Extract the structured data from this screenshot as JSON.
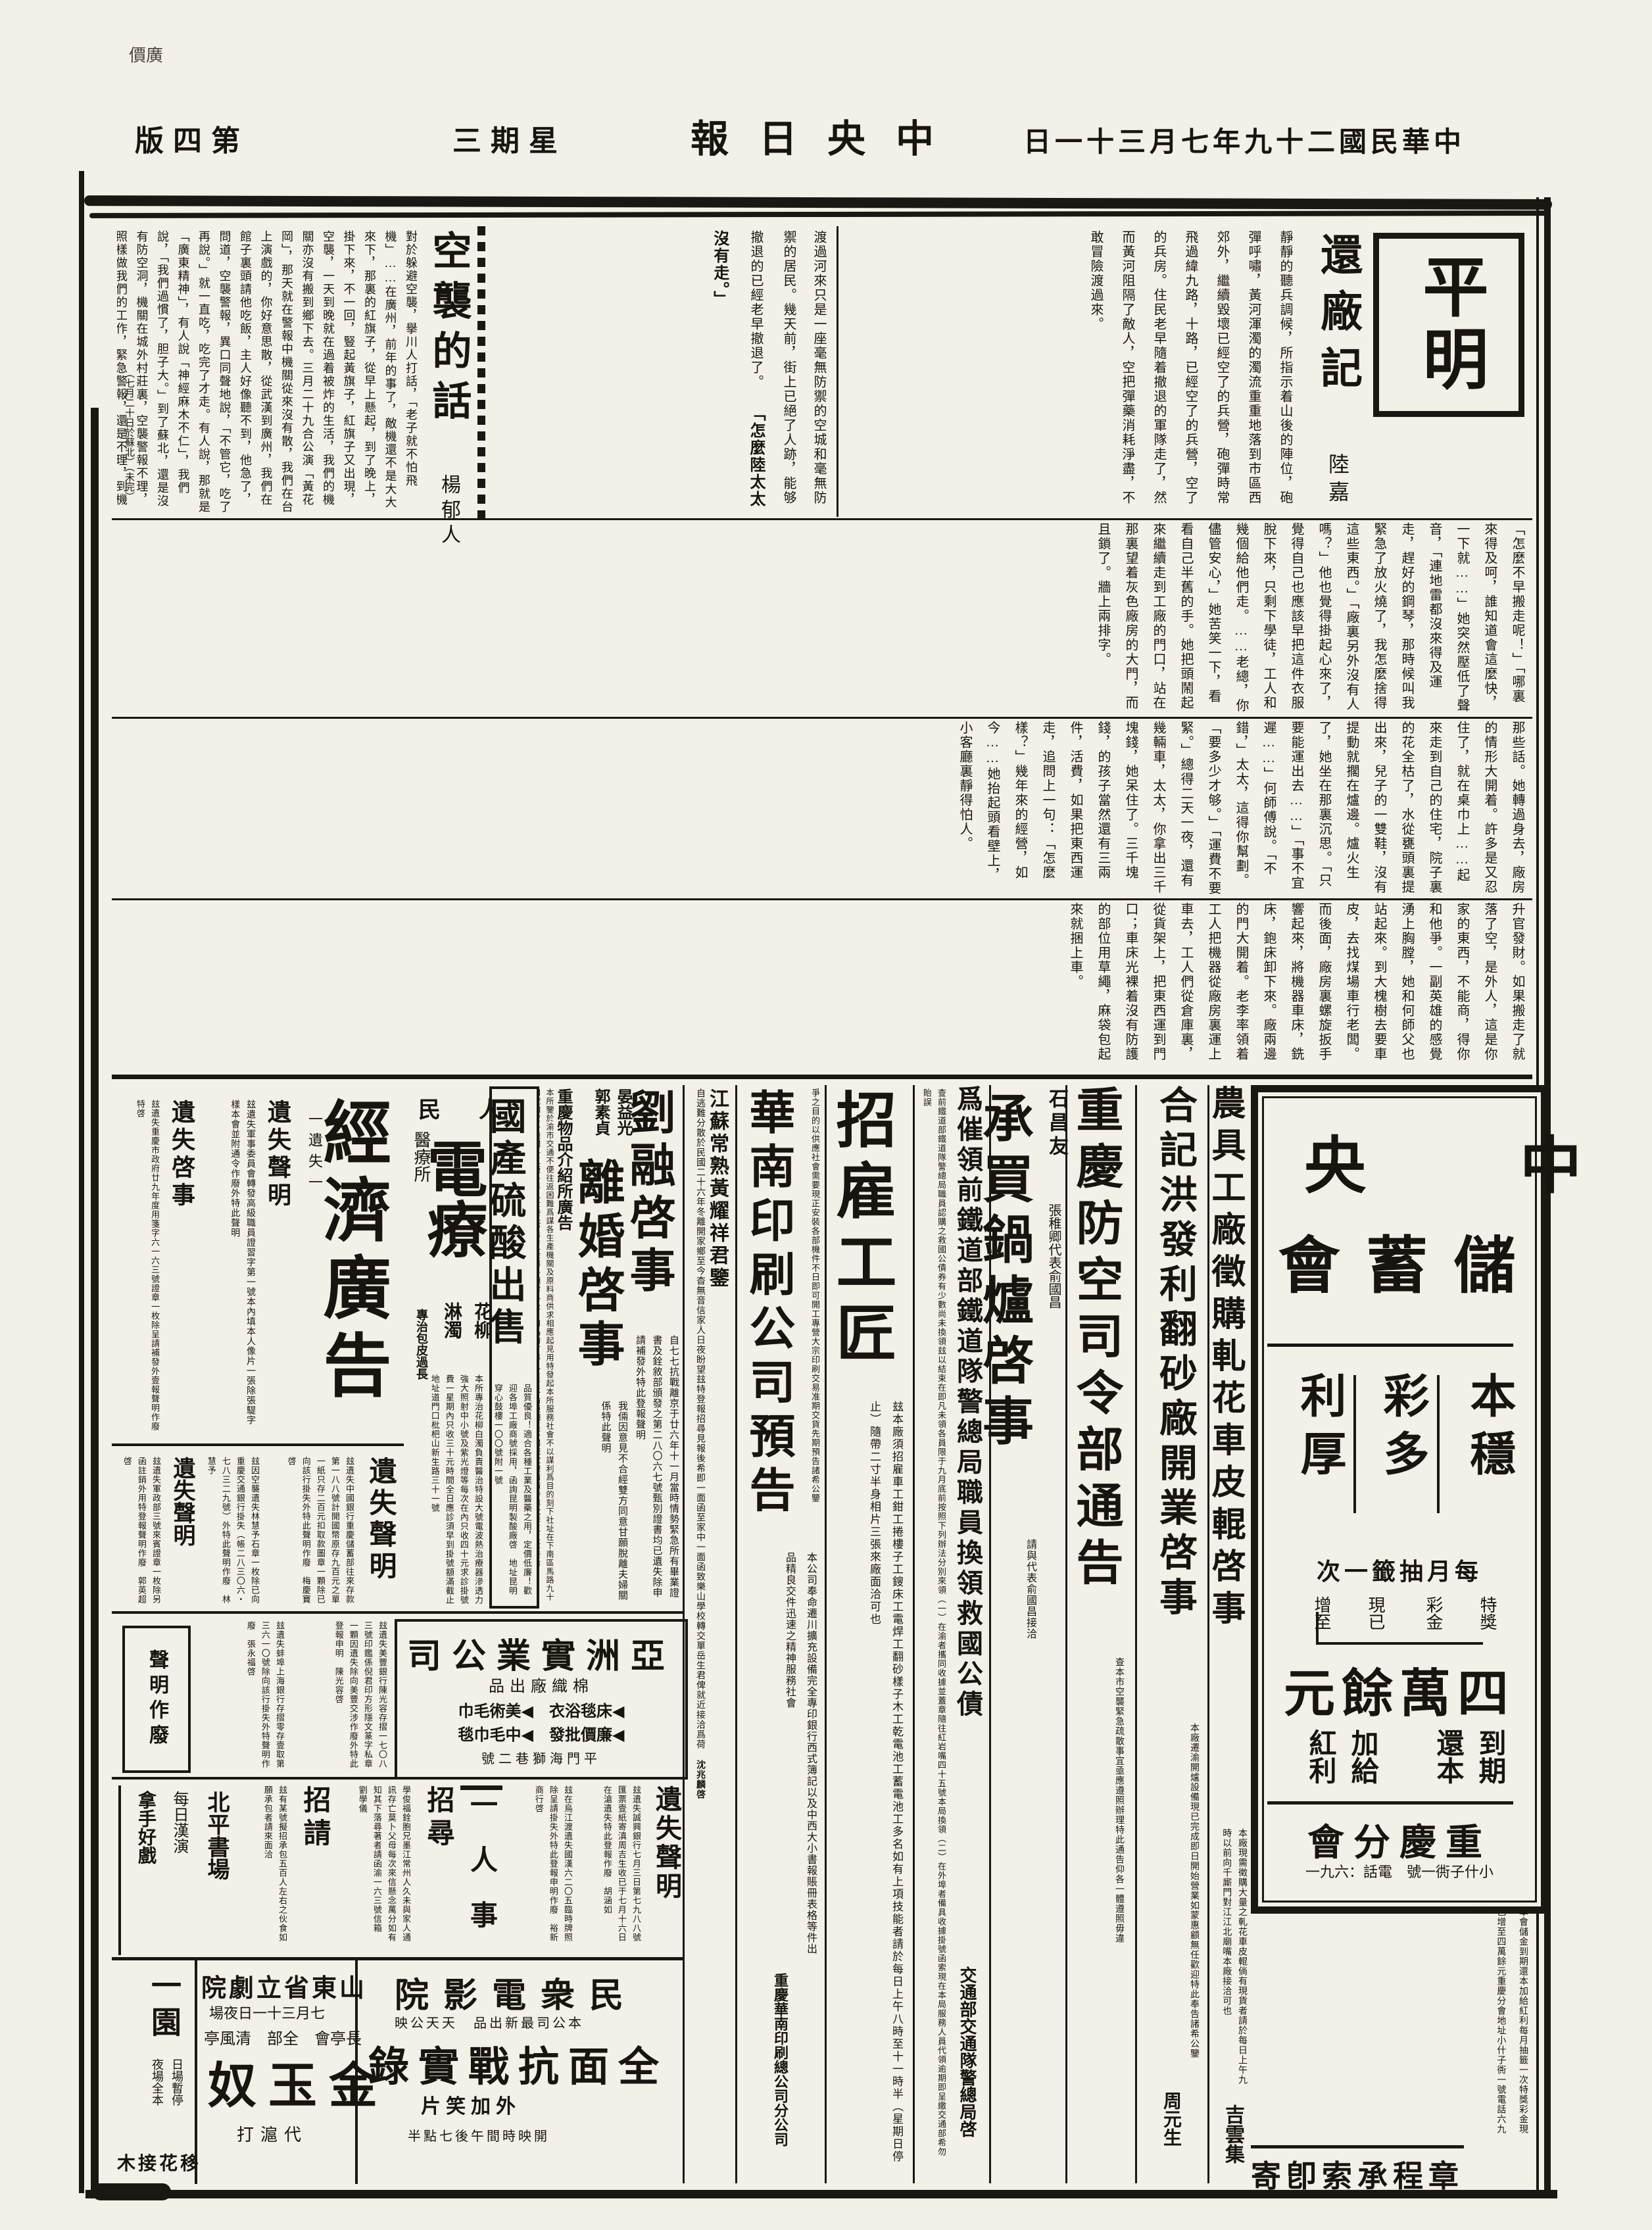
{
  "page": {
    "paper_color": "#f3f0e8",
    "ink_color": "#181510",
    "corner_note": "價廣"
  },
  "header": {
    "edition_rtl": "版四第",
    "weekday_rtl": "三期星",
    "paper_rtl": "報日央中",
    "date_rtl": "日一十三月七年九十二國民華中"
  },
  "masthead": {
    "title": "平明"
  },
  "articles": {
    "huanchang": {
      "title": "還廠記",
      "author": "陸嘉",
      "body1": "靜靜的聽兵調候，所指示着山後的陣位，砲彈呼嘯，黃河渾濁的濁流重重地落到市區西郊外，繼續毀壞已經空了的兵營，砲彈時常飛過緯九路，十路，已經空了的兵營，空了的兵房。住民老早隨着撤退的軍隊走了，然而黃河阻隔了敵人，空把彈藥消耗淨盡，不敢冒險渡過來。",
      "mid": "渡過河來只是一座毫無防禦的空城和毫無防禦的居民。幾天前，街上已絕了人跡，能够撤退的已經老早撤退了。",
      "quote": "「怎麼陸太太沒有走。」",
      "body2": "「怎麼不早搬走呢！」「哪裏來得及呵，誰知道會這麼快，一下就……」她突然壓低了聲音，「連地雷都沒來得及運走，趕好的鋼琴，那時候叫我緊急了放火燒了，我怎麼捨得這些東西。」「廠裏另外沒有人嗎？」他也覺得掛起心來了，覺得自己也應該早把這件衣服脫下來，只剩下學徒，工人和幾個給他們走。……老總，你儘管安心，」她苦笑一下，看看自己半舊的手。她把頭鬧起來繼續走到工廠的門口，站在那裏望着灰色廠房的大門，而且鎖了。牆上兩排字。",
      "body3": "那些話。她轉過身去，廠房的情形大開着。許多是又忍住了，就在桌巾上……起來走到自己的住宅，院子裏的花全枯了，水從甕頭裏提出來，兒子的一雙鞋，沒有提動就擱在爐邊。爐火生了，她坐在那裏沉思。「只要能運出去……」「事不宜遲……」何師傅說。「不錯，」太太，這得你幫劃。「要多少才够。」「運費不要緊。」總得二天一夜，還有幾輛車，太太，你拿出三千塊錢，她呆住了。三千塊錢，的孩子當然還有三兩件，活費，如果把東西運走，追問上一句：「怎麼樣？」幾年來的經營，如今……她抬起頭看壁上，小客廳裏靜得怕人。",
      "body4": "升官發財。如果搬走了就落了空，是外人，這是你家的東西，不能商，得你和他爭。一副英雄的感覺湧上胸膛，她和何師父也站起來。到大槐樹去要車皮，去找煤場車行老闆。而後面，廠房裏螺旋扳手響起來，將機器車床，銑床，鉋床卸下來。廠兩邊的門大開着。老李率領着工人把機器從廠房裏運上車去，工人們從倉庫裏，從貨架上，把東西運到門口；車床光裸着沒有防護的部位用草繩，麻袋包起來就捆上車。"
    },
    "kongxi": {
      "title": "空襲的話",
      "author": "楊郁人",
      "body": "對於躲避空襲，擧川人打話，「老子就不怕飛機」……在廣州，前年的事了，敵機還不是大大來下，那裏的紅旗子，從早上懸起，到了晚上，掛下來，不一回，豎起黃旗子，紅旗子又出現，空襲，一天到晚就在過着被炸的生活，我們的機關亦沒有搬到鄉下去。三月二十九合公演「黃花岡」，那天就在警報中機關從來沒有散，我們在台上演戲的，你好意思散，從武漢到廣州，我們在館子裏頭請他吃飯，主人好像聽不到，他急了，問道，空襲警報，異口同聲地說，「不管它，吃了再說。」就一直吃，吃完了才走。有人說，那就是「廣東精神」，有人說「神經麻木不仁」，我們說，「我們過慣了，胆子大。」到了蘇北，還是沒有防空洞，機關在城外村莊裏，空襲警報不理，照樣做我們的工作，緊急警報，還是不理，到機聲隆隆，我們這才離開辦公廳疏散到田隴去，敵機一過，我們馬上來。",
      "footnote": "（七月二十日於蘇北）（未完）"
    }
  },
  "ads": {
    "savings": {
      "name_line1_rtl": "央　中",
      "name_line2_rtl": "會 蓄 儲",
      "slogan_right": "本穩",
      "slogan_mid": "彩多",
      "slogan_left": "利厚",
      "draw_rtl": "次一籤抽月每",
      "prize1": "特獎",
      "prize2": "彩金",
      "prize3": "現已",
      "prize4": "增至",
      "amount_rtl": "元餘萬四",
      "t1": "到期",
      "t2": "還本",
      "t3": "加給",
      "t4": "紅利",
      "branch_rtl": "會分慶重",
      "addr_rtl": "一九六：話電　號一衖子什小",
      "below_note": "本會儲金到期還本加給紅利每月抽籤一次特獎彩金現已增至四萬餘元重慶分會地址小什子衖一號電話六九一",
      "footer_rtl": "寄卽索承程章"
    },
    "nongju": {
      "headline": "農具工廠徵購軋花車皮輥啓事",
      "body": "本廠現需徵購大量之軋花車皮輥倘有現貨者請於每日上午九時以前向千廝門對江江北廟嘴本廠接洽可也",
      "sig": "吉雲集"
    },
    "hejii": {
      "headline": "合記洪發利翻砂廠開業啓事",
      "body": "本廠遷渝開爐設備現已完成即日開始營業如蒙惠顧無任歡迎特此奉告諸希公鑒",
      "sig": "周元生"
    },
    "fangkong": {
      "headline": "重慶防空司令部通告",
      "body": "查本市空襲緊急疏散事宜亟應遵照辦理特此通告仰各一體遵照毋違"
    },
    "guolu": {
      "who": "石昌友",
      "rep": "張稚卿代表俞國昌",
      "headline": "承買鍋爐啓事",
      "body": "請與代表俞國昌接洽"
    },
    "cuiling": {
      "headline": "爲催領前鐵道部鐵道隊警總局職員換領救國公債",
      "body": "查前鐵道部鐵道隊警總局職員認購之救國公債券有少數尚未換領玆以結束在即凡未領各員限于九月底前按照下列辦法分別來領（一）在渝者攜同收據並蓋章隨往紅岩嘴四十五號本局換領（二）在外埠者備具收據掛號函索現在本局服務人員代領逾期即呈繳交通部希勿貽誤",
      "sig": "交通部交通隊警總局啓"
    },
    "zhaogu": {
      "headline": "招雇工匠",
      "body": "玆本廠須招雇車工鉗工捲樓子工鎪床工電焊工翻砂樣子木工乾電池工蓄電池工多名如有上項技能者請於每日上午八時至十一時半（星期日停止）隨帶二寸半身相片三張來廠面洽可也"
    },
    "huanan": {
      "intro": "爭之目的以供應社會需要現正安裝各部機件不日即可開工專營大宗印刷交易准期交貨先期預告諸希公鑒",
      "headline": "華南印刷公司預告",
      "body": "本公司奉命遷川擴充設備完全專印銀行西式簿記以及中西大小書報賬冊表格等件出品精良交件迅速之精神服務社會",
      "sig": "重慶華南印刷總公司分公司"
    },
    "xunren": {
      "headline": "江蘇常熟黃耀祥君鑒",
      "body": "自逃難分散於民國二十六年冬離開家鄉至今杳無音信家人日夜盼望玆特登報招尋見報後希即一面函至家中一面函致樂山學校轉交單岳生君俾就近接洽爲荷",
      "sig": "沈兆麟啓"
    },
    "liurong": {
      "headline": "劉融啓事",
      "body": "自七七抗戰離京于廿六年十一月當時情勢緊急所有畢業證書及銓敘部頒發之第二八〇六七號甄別證書均已遺失除申請補發外特此登報聲明"
    },
    "lihun": {
      "name1": "晏益光",
      "name2": "郭素貞",
      "headline": "離婚啓事",
      "body": "我倆因意見不合經雙方同意甘願脫離夫婦關係特此聲明"
    },
    "wupin": {
      "headline": "重慶物品介紹所廣告",
      "body": "本所鑒於渝市交通不便往返困難爲謀各生產機關及原料商供求相應起見用特發起本所服務社會不以謀利爲目的刻下社址在下南區馬路九十四號如蒙各機關各工廠各界人士委托買賣五金與各項材料及日用品均有專人負責不論鉅細莫不竭誠歡迎請隨時與沈李王三君接洽"
    },
    "liusuan": {
      "headline": "國產硫酸出售",
      "body": "品質優良！適合各種工業及醫藥之用，定價低廉！歡迎各埠工廠商號採用，函詢昆明製酸廠啓　地址昆明穿心鼓樓一〇〇號附一號"
    },
    "dianliao": {
      "pre_rtl": "民　人",
      "headline": "電療",
      "tag1": "花柳",
      "tag2": "淋濁",
      "label": "醫療所",
      "note": "專治包皮過長",
      "body": "本所專治花柳白濁負責醫治特設大號電波熱治療器滲透力強大照射中小號及紫光燈等每次在內只收四十元求診掛號費一星期內只收三十元時間全日應診須早到掛號額滿截止地址道門口枇杷山新生路三十一號"
    },
    "jingji": {
      "headline": "經濟廣告",
      "label": "一遺失一",
      "i1_title": "遺失聲明",
      "i1_body": "玆遺失軍事委員會轉發高級職員證習字第一號本內填本人像片一張除張騠字樣本會並附通令作廢外特此聲明",
      "i2_title": "遺失啓事",
      "i2_body": "玆遺失重慶市政府廿九年度用箋字六一六三號證章一枚除呈請補發外壹報聲明作廢特啓"
    },
    "row2": {
      "a_title": "遺失聲明",
      "a_body": "玆遺失中國銀行重慶儲蓄部往來存款第一八八號計開國幣原存九百元之單一紙只存二百元扣取款圖章一顆除已向該行掛失外特此聲明作廢　梅慶寶啓",
      "b_body": "玆因空襲遺失林慧予石章一枚除已向重慶交通銀行掛失（帳二八三〇六・七八三二九號）外特此聲明作廢　林慧予",
      "c_title": "遺失聲明",
      "c_body": "玆遺失軍政部三號來賓證章一枚除另函註銷外用特登報聲明作廢　郭英超啓"
    },
    "yazhou": {
      "headline_rtl": "司公業實洲亞",
      "sub_rtl": "品出廠織棉",
      "p1_rtl": "巾毛術美",
      "p2_rtl": "衣浴毯床",
      "p3_rtl": "毯巾毛中",
      "p4_rtl": "發批價廉",
      "addr_rtl": "號二巷獅海門平",
      "marker": "◀"
    },
    "row3": {
      "a_body": "玆遺失美豐銀行陳光容存摺一七〇八三號印鑑係倪君印方形隱文篆字私章一顆因遺失除向美豐交涉作廢外特此登報申明　陳光容啓",
      "b_body": "玆遺失蚌埠上海銀行存摺零存壹取第三六一〇號除向該行掛失外特聲明作廢　張永福啓",
      "c_title": "聲明作廢"
    },
    "row4": {
      "a_title": "遺失聲明",
      "a_body": "玆遺失誠興銀行七月三日第七九八八號匯票壹紙寄滇周吉生收已于七月十六日在滄遺失特此登報作廢　胡涵如",
      "b_body": "玆在烏江渡遺失國漢六二〇五臨時牌照除呈請掛失外特此登報申明作廢　裕新商行啓",
      "section_label": "一　人　事",
      "c_title": "招尋",
      "c_body": "學俊福銓胞兄墨江常州人久未與家人通訊存亡莫卜父母每次來信懸念萬分如有知其下落尋著者請函渝一六三號信箱　劉學儀",
      "d_title": "招請",
      "d_body": "玆有某號擬招承包五百人左右之伙食如願承包者請來面洽",
      "e_line1": "北平書場",
      "e_line2": "每日漢演",
      "e_line3": "拿手好戲"
    }
  },
  "theaters": {
    "minzhong": {
      "title_rtl": "院影電衆民",
      "tag_rtl": "映公天天　品出新最司公本",
      "feature_rtl": "錄實戰抗面全",
      "extra_rtl": "片笑加外",
      "time_rtl": "半點七後午間時映開"
    },
    "shandong": {
      "title_rtl": "院劇立省東山",
      "date_rtl": "場夜日一十三月七",
      "plays_rtl": "亭風清　部全　會亭長",
      "feature_rtl": "奴玉金",
      "extra_rtl": "打滬代"
    },
    "yiyuan": {
      "title": "一園",
      "line1": "日場暫停",
      "line2": "夜場全本",
      "feature_rtl": "木接花移"
    }
  }
}
